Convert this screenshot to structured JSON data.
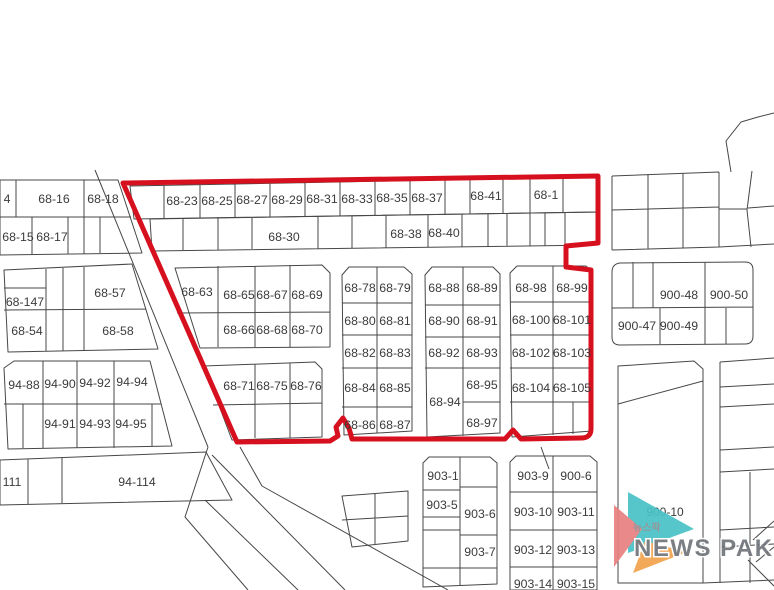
{
  "colors": {
    "region_outline": "#d6101e",
    "parcel_line": "#474747",
    "label_text": "#3b3b3b",
    "logo_teal": "#49c2c6",
    "logo_salmon": "#e8807f",
    "logo_orange": "#f2a24d",
    "logo_text": "#70757a"
  },
  "map": {
    "labels": {
      "nw_row1": [
        "4",
        "68-16",
        "68-18"
      ],
      "nw_row2": [
        "68-15",
        "68-17"
      ],
      "top_row1": [
        "68-23",
        "68-25",
        "68-27",
        "68-29",
        "68-31",
        "68-33",
        "68-35",
        "68-37",
        "68-41",
        "68-1"
      ],
      "top_row2": [
        "68-30",
        "68-38",
        "68-40"
      ],
      "west_block": [
        "68-147",
        "68-54",
        "68-57",
        "68-58"
      ],
      "mid_block": [
        "68-63",
        "68-65",
        "68-67",
        "68-69",
        "68-66",
        "68-68",
        "68-70"
      ],
      "mid_block2": [
        "68-71",
        "68-75",
        "68-76"
      ],
      "col_block1": [
        "68-78",
        "68-79",
        "68-80",
        "68-81",
        "68-82",
        "68-83",
        "68-84",
        "68-85",
        "68-86",
        "68-87"
      ],
      "col_block2": [
        "68-88",
        "68-89",
        "68-90",
        "68-91",
        "68-92",
        "68-93",
        "68-94",
        "68-95",
        "68-97"
      ],
      "col_block3": [
        "68-98",
        "68-99",
        "68-100",
        "68-101",
        "68-102",
        "68-103",
        "68-104",
        "68-105"
      ],
      "east_block": [
        "900-48",
        "900-50",
        "900-47",
        "900-49"
      ],
      "sw_block": [
        "94-88",
        "94-90",
        "94-92",
        "94-94",
        "94-91",
        "94-93",
        "94-95"
      ],
      "sw_row": [
        "111",
        "94-114"
      ],
      "south_block1": [
        "903-1",
        "903-5",
        "903-6",
        "903-7"
      ],
      "south_block2": [
        "903-9",
        "900-6",
        "903-10",
        "903-11",
        "903-12",
        "903-13",
        "903-14",
        "903-15"
      ],
      "east_parcel": "900-10"
    }
  },
  "logo": {
    "korean": "뉴스팍",
    "name": "NEWS PAK"
  }
}
